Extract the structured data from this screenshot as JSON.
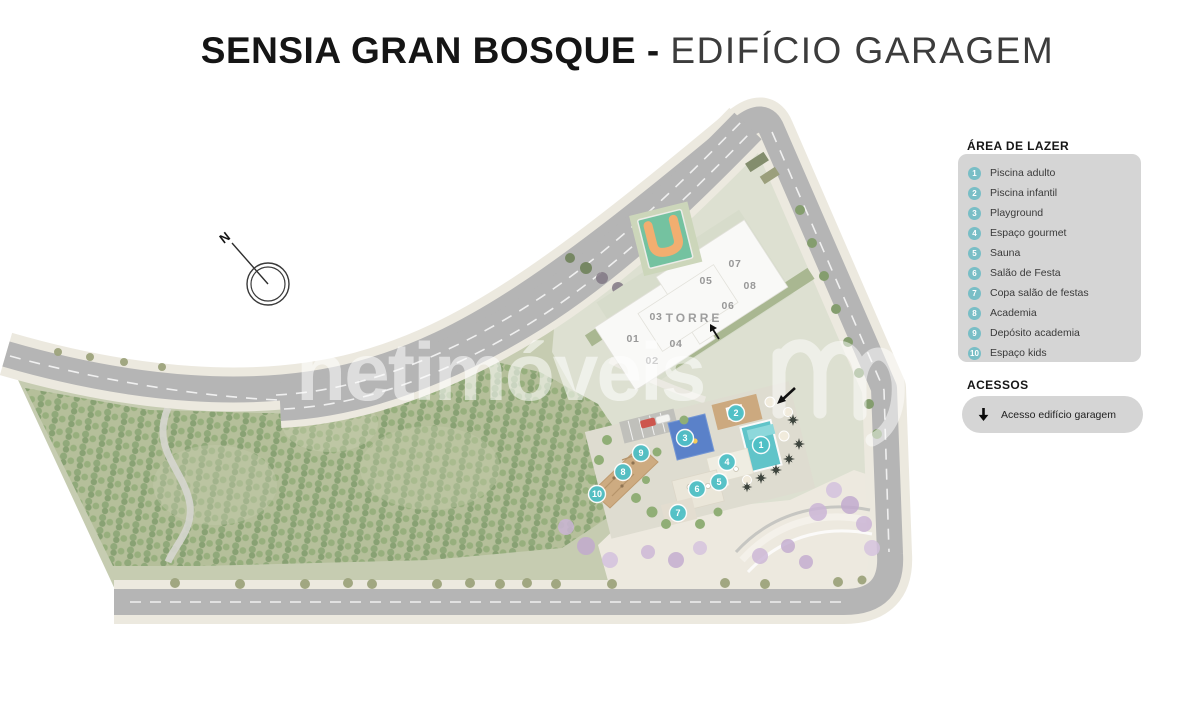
{
  "title": {
    "bold": "SENSIA GRAN BOSQUE - ",
    "light": "EDIFÍCIO GARAGEM"
  },
  "legend": {
    "header": "ÁREA DE LAZER",
    "items": [
      {
        "number": "1",
        "label": "Piscina adulto"
      },
      {
        "number": "2",
        "label": "Piscina infantil"
      },
      {
        "number": "3",
        "label": "Playground"
      },
      {
        "number": "4",
        "label": "Espaço gourmet"
      },
      {
        "number": "5",
        "label": "Sauna"
      },
      {
        "number": "6",
        "label": "Salão de Festa"
      },
      {
        "number": "7",
        "label": "Copa salão de festas"
      },
      {
        "number": "8",
        "label": "Academia"
      },
      {
        "number": "9",
        "label": "Depósito academia"
      },
      {
        "number": "10",
        "label": "Espaço kids"
      }
    ]
  },
  "acessos": {
    "header": "ACESSOS",
    "items": [
      {
        "icon": "down-arrow",
        "label": "Acesso edifício garagem"
      }
    ]
  },
  "map": {
    "tower_label": "TORRE",
    "units": [
      {
        "label": "01"
      },
      {
        "label": "02"
      },
      {
        "label": "03"
      },
      {
        "label": "04"
      },
      {
        "label": "05"
      },
      {
        "label": "06"
      },
      {
        "label": "07"
      },
      {
        "label": "08"
      }
    ],
    "markers": [
      {
        "number": "1"
      },
      {
        "number": "2"
      },
      {
        "number": "3"
      },
      {
        "number": "4"
      },
      {
        "number": "5"
      },
      {
        "number": "6"
      },
      {
        "number": "7"
      },
      {
        "number": "8"
      },
      {
        "number": "9"
      },
      {
        "number": "10"
      }
    ],
    "compass": "N"
  },
  "watermark": {
    "text": "netimóveis"
  },
  "colors": {
    "accent_teal": "#5bc2c9",
    "legend_panel": "#d5d5d5",
    "road": "#a8a8a8",
    "field_green": "#a8b489",
    "pool_teal": "#45bac0",
    "playground_blue": "#3e6cc0",
    "court_orange": "#f0a058",
    "court_green": "#5cb890",
    "purple_trees": "#c2a8cf",
    "deck_wood": "#c49a69"
  }
}
